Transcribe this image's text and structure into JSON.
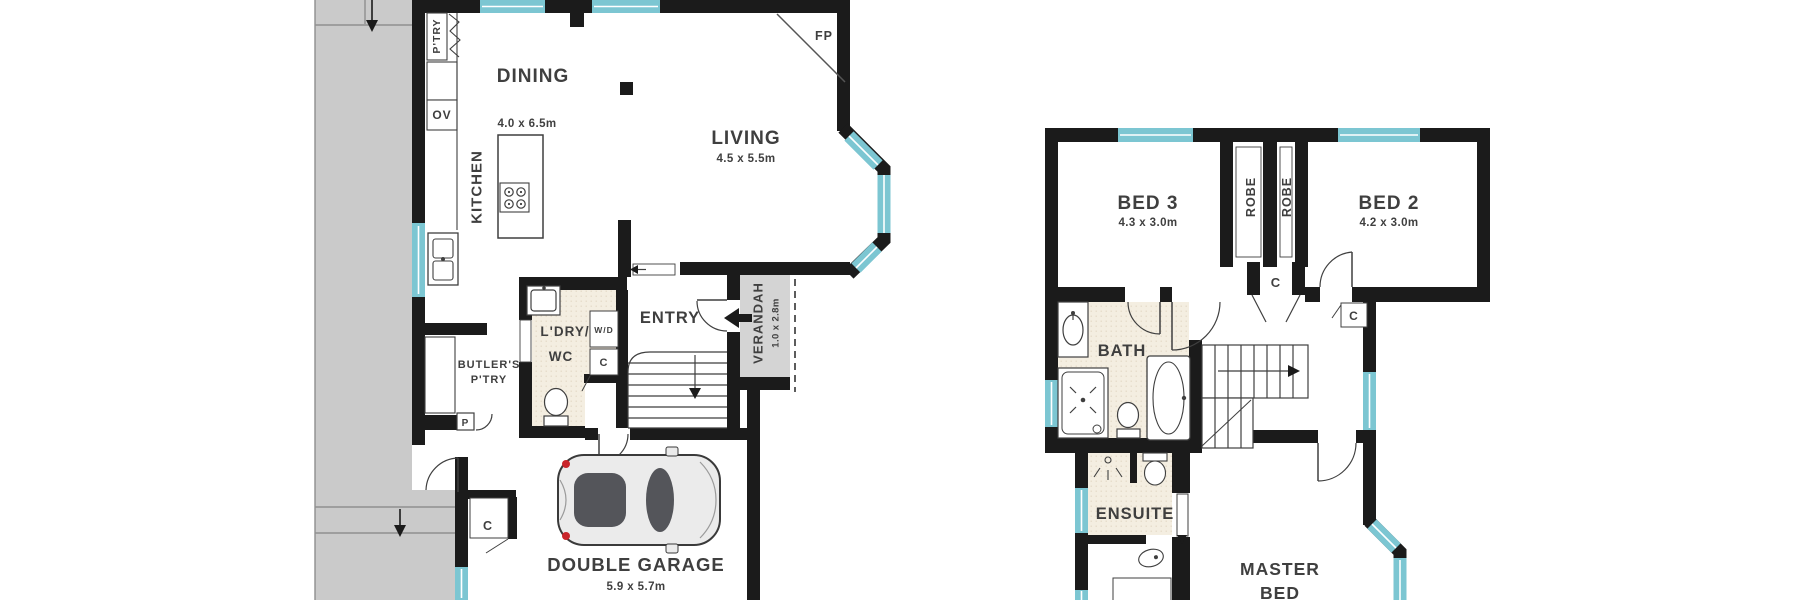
{
  "document": {
    "type": "residential floor plan, two levels",
    "background": "#ffffff"
  },
  "colors": {
    "wall": "#1b1b1b",
    "window_glass": "#7cc6d2",
    "driveway": "#cacaca",
    "driveway_line": "#8f8f8f",
    "verandah_fill": "#d4d4d4",
    "wet_area_floor": "#f4eee1",
    "label_text": "#3f3f3f",
    "car_body": "#ebebeb",
    "car_glass": "#54555a",
    "car_accent": "#c9252b"
  },
  "ground_floor": {
    "pantry_label": "P'TRY",
    "oven_label": "OV",
    "kitchen_label": "KITCHEN",
    "dining": {
      "name": "DINING",
      "dims": "4.0 x 6.5m"
    },
    "living": {
      "name": "LIVING",
      "dims": "4.5 x 5.5m"
    },
    "fireplace_label": "FP",
    "laundry": {
      "line1": "L'DRY/",
      "line2": "WC"
    },
    "washer_dryer_label": "W/D",
    "understair_cupboard_label": "C",
    "entry_label": "ENTRY",
    "verandah": {
      "name": "VERANDAH",
      "dims": "1.0 x 2.8m"
    },
    "butlers_pantry": {
      "line1": "BUTLER'S",
      "line2": "P'TRY"
    },
    "pantry_cupboard_label": "P",
    "garage_cupboard_label": "C",
    "garage": {
      "name": "DOUBLE GARAGE",
      "dims": "5.9 x 5.7m"
    }
  },
  "upper_floor": {
    "bed3": {
      "name": "BED 3",
      "dims": "4.3 x 3.0m"
    },
    "bed2": {
      "name": "BED 2",
      "dims": "4.2 x 3.0m"
    },
    "robe_left_label": "ROBE",
    "robe_right_label": "ROBE",
    "hall_cupboard_label": "C",
    "bed2_cupboard_label": "C",
    "bath_label": "BATH",
    "ensuite_label": "ENSUITE",
    "master_bed": {
      "line1": "MASTER",
      "line2": "BED"
    }
  }
}
